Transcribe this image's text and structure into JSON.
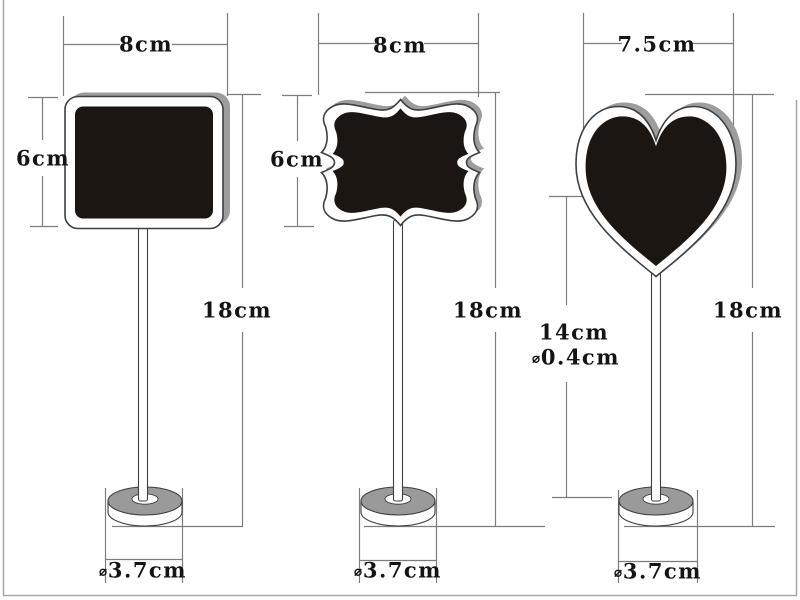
{
  "colors": {
    "bg": "#ffffff",
    "line": "#7d7d7d",
    "outline": "#3f3f3f",
    "board": "#1c1613",
    "shadow": "#9d9d9d",
    "base-top": "#9a9a9a",
    "text": "#141414",
    "frame": "#a8a8a8"
  },
  "signs": [
    {
      "shape": "rounded rectangle chalkboard on stand",
      "width_label": "8cm",
      "height_label": "6cm",
      "total_height_label": "18cm",
      "base_diameter_symbol": "⌀",
      "base_diameter_label": "3.7cm"
    },
    {
      "shape": "ornate bracket plaque chalkboard on stand",
      "width_label": "8cm",
      "height_label": "6cm",
      "total_height_label": "18cm",
      "base_diameter_symbol": "⌀",
      "base_diameter_label": "3.7cm"
    },
    {
      "shape": "heart chalkboard on stand",
      "width_label": "7.5cm",
      "total_height_label": "18cm",
      "stick_length_label": "14cm",
      "stick_diameter_symbol": "⌀",
      "stick_diameter_label": "0.4cm",
      "base_diameter_symbol": "⌀",
      "base_diameter_label": "3.7cm"
    }
  ]
}
